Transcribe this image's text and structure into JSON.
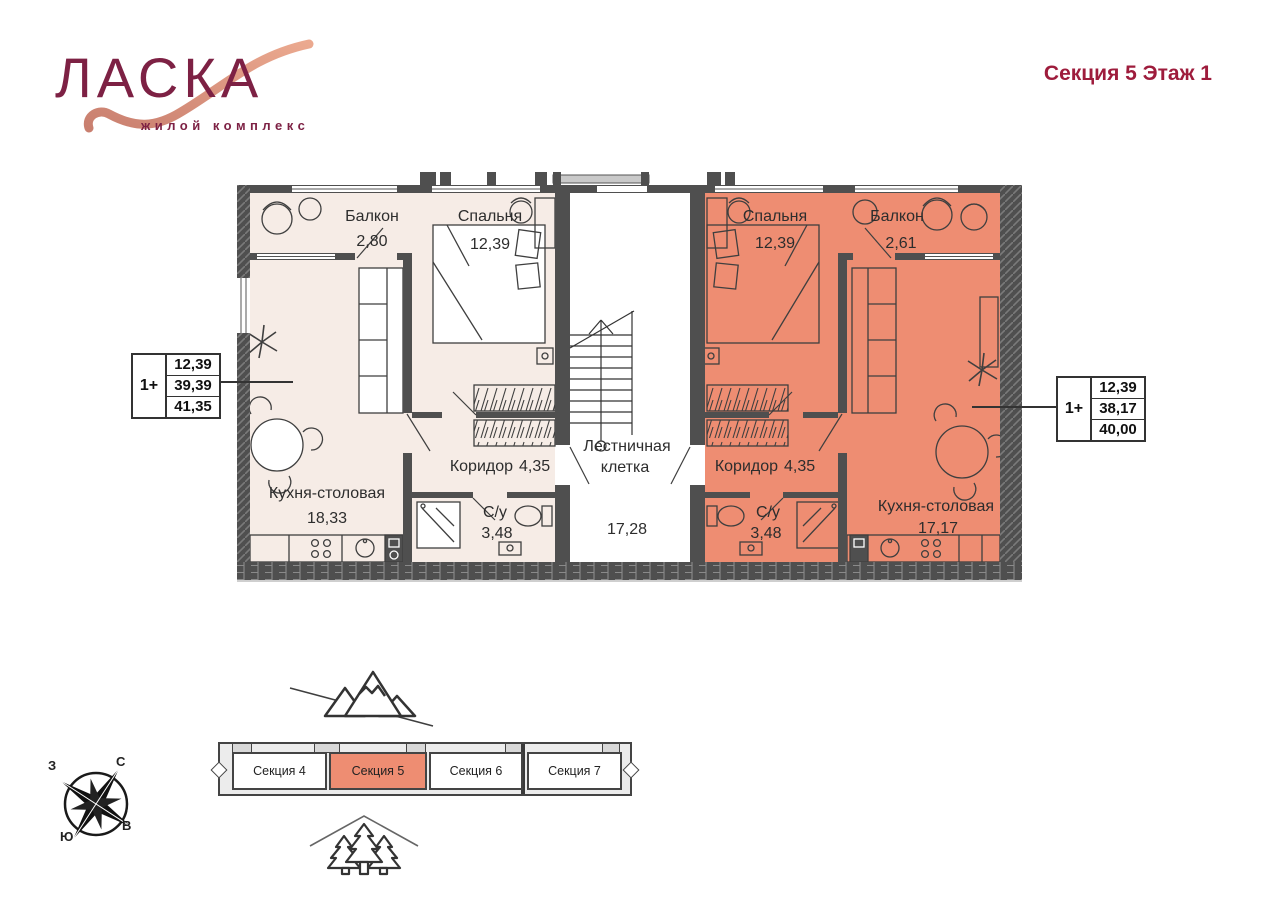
{
  "header": {
    "logo_title": "ЛАСКА",
    "logo_subtitle": "жилой комплекс",
    "page_title": "Секция 5 Этаж 1"
  },
  "floor_plan": {
    "stairwell": {
      "label_line1": "Лестничная",
      "label_line2": "клетка",
      "area": "17,28"
    },
    "left_apartment": {
      "type_label": "1+",
      "stats": [
        "12,39",
        "39,39",
        "41,35"
      ],
      "rooms": {
        "balcony": {
          "name": "Балкон",
          "area": "2,80"
        },
        "bedroom": {
          "name": "Спальня",
          "area": "12,39"
        },
        "kitchen": {
          "name": "Кухня-столовая",
          "area": "18,33"
        },
        "corridor": {
          "name": "Коридор",
          "area": "4,35"
        },
        "bathroom": {
          "name": "С/у",
          "area": "3,48"
        }
      }
    },
    "right_apartment": {
      "type_label": "1+",
      "stats": [
        "12,39",
        "38,17",
        "40,00"
      ],
      "rooms": {
        "bedroom": {
          "name": "Спальня",
          "area": "12,39"
        },
        "balcony": {
          "name": "Балкон",
          "area": "2,61"
        },
        "kitchen": {
          "name": "Кухня-столовая",
          "area": "17,17"
        },
        "corridor": {
          "name": "Коридор",
          "area": "4,35"
        },
        "bathroom": {
          "name": "С/у",
          "area": "3,48"
        }
      }
    }
  },
  "building_strip": {
    "sections": [
      {
        "label": "Секция 4",
        "highlighted": false
      },
      {
        "label": "Секция 5",
        "highlighted": true
      },
      {
        "label": "Секция 6",
        "highlighted": false
      },
      {
        "label": "Секция 7",
        "highlighted": false
      }
    ]
  },
  "compass": {
    "north": "С",
    "south": "Ю",
    "west": "З",
    "east": "В"
  },
  "colors": {
    "accent_maroon": "#8e1f3e",
    "apartment_neutral_fill": "#f6ece6",
    "apartment_highlight_fill": "#ee8d72",
    "wall": "#4f4f4f"
  }
}
